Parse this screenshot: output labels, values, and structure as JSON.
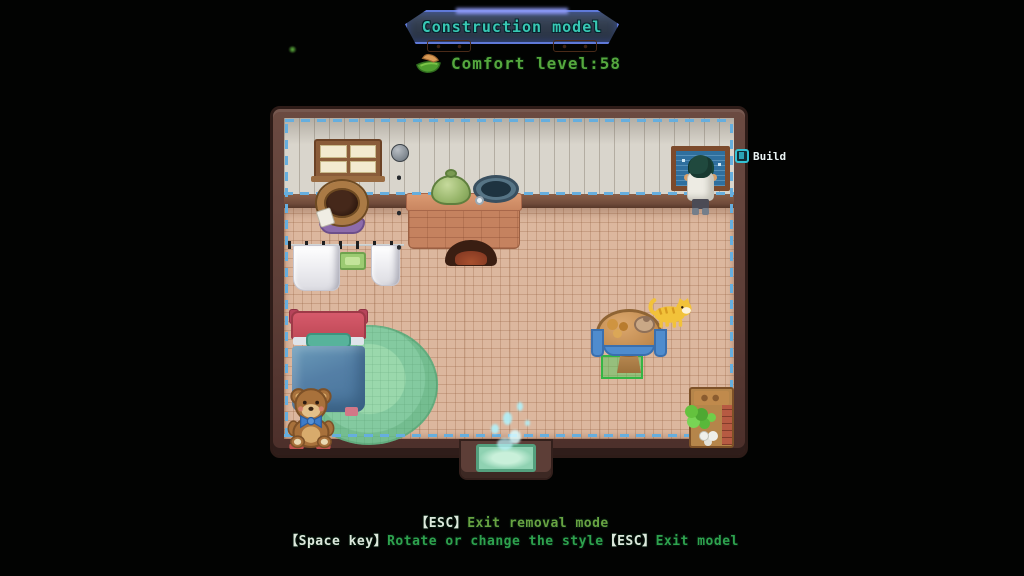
{
  "banner": {
    "title": "Construction model"
  },
  "comfort": {
    "label": "Comfort level:58"
  },
  "build_prompt": {
    "label": "Build"
  },
  "help": {
    "line1": {
      "key": "【ESC】",
      "text": "Exit removal mode"
    },
    "line2": {
      "key1": "【Space key】",
      "text1": "Rotate or change the style",
      "key2": "【ESC】",
      "text2": "Exit model"
    }
  },
  "scene": {
    "objects": [
      "window",
      "storage-barrel",
      "floor-lamp",
      "kitchen-counter-stove",
      "cooking-pot",
      "frying-pan",
      "clothes-line",
      "towel-left",
      "towel-right",
      "bath-mat",
      "bed",
      "round-rug",
      "teddy-bear",
      "dining-table",
      "table-food",
      "cat",
      "highlight-tile",
      "plant-shelf",
      "wall-blueprint",
      "player-character",
      "entrance-doorway",
      "entrance-mat"
    ]
  },
  "colors": {
    "background": "#020302",
    "banner_text": "#38c8b4",
    "banner_glow": "#5f79d8",
    "banner_fill": "#323d4e",
    "comfort_text": "#55a83e",
    "help_key": "#dce8dc",
    "help_text_line1": "#68a342",
    "help_text_line2": "#2ea24e",
    "build_key_accent": "#33c2d4",
    "build_label": "#e9f3f3",
    "selection_dash": "#66aede",
    "wall_frame": "#5d3e37",
    "wall_planks": "#d9d5cc",
    "floor_base": "#dcb79e",
    "tile_highlight": "#35b545",
    "entrance_glow": "#aef4ff"
  }
}
